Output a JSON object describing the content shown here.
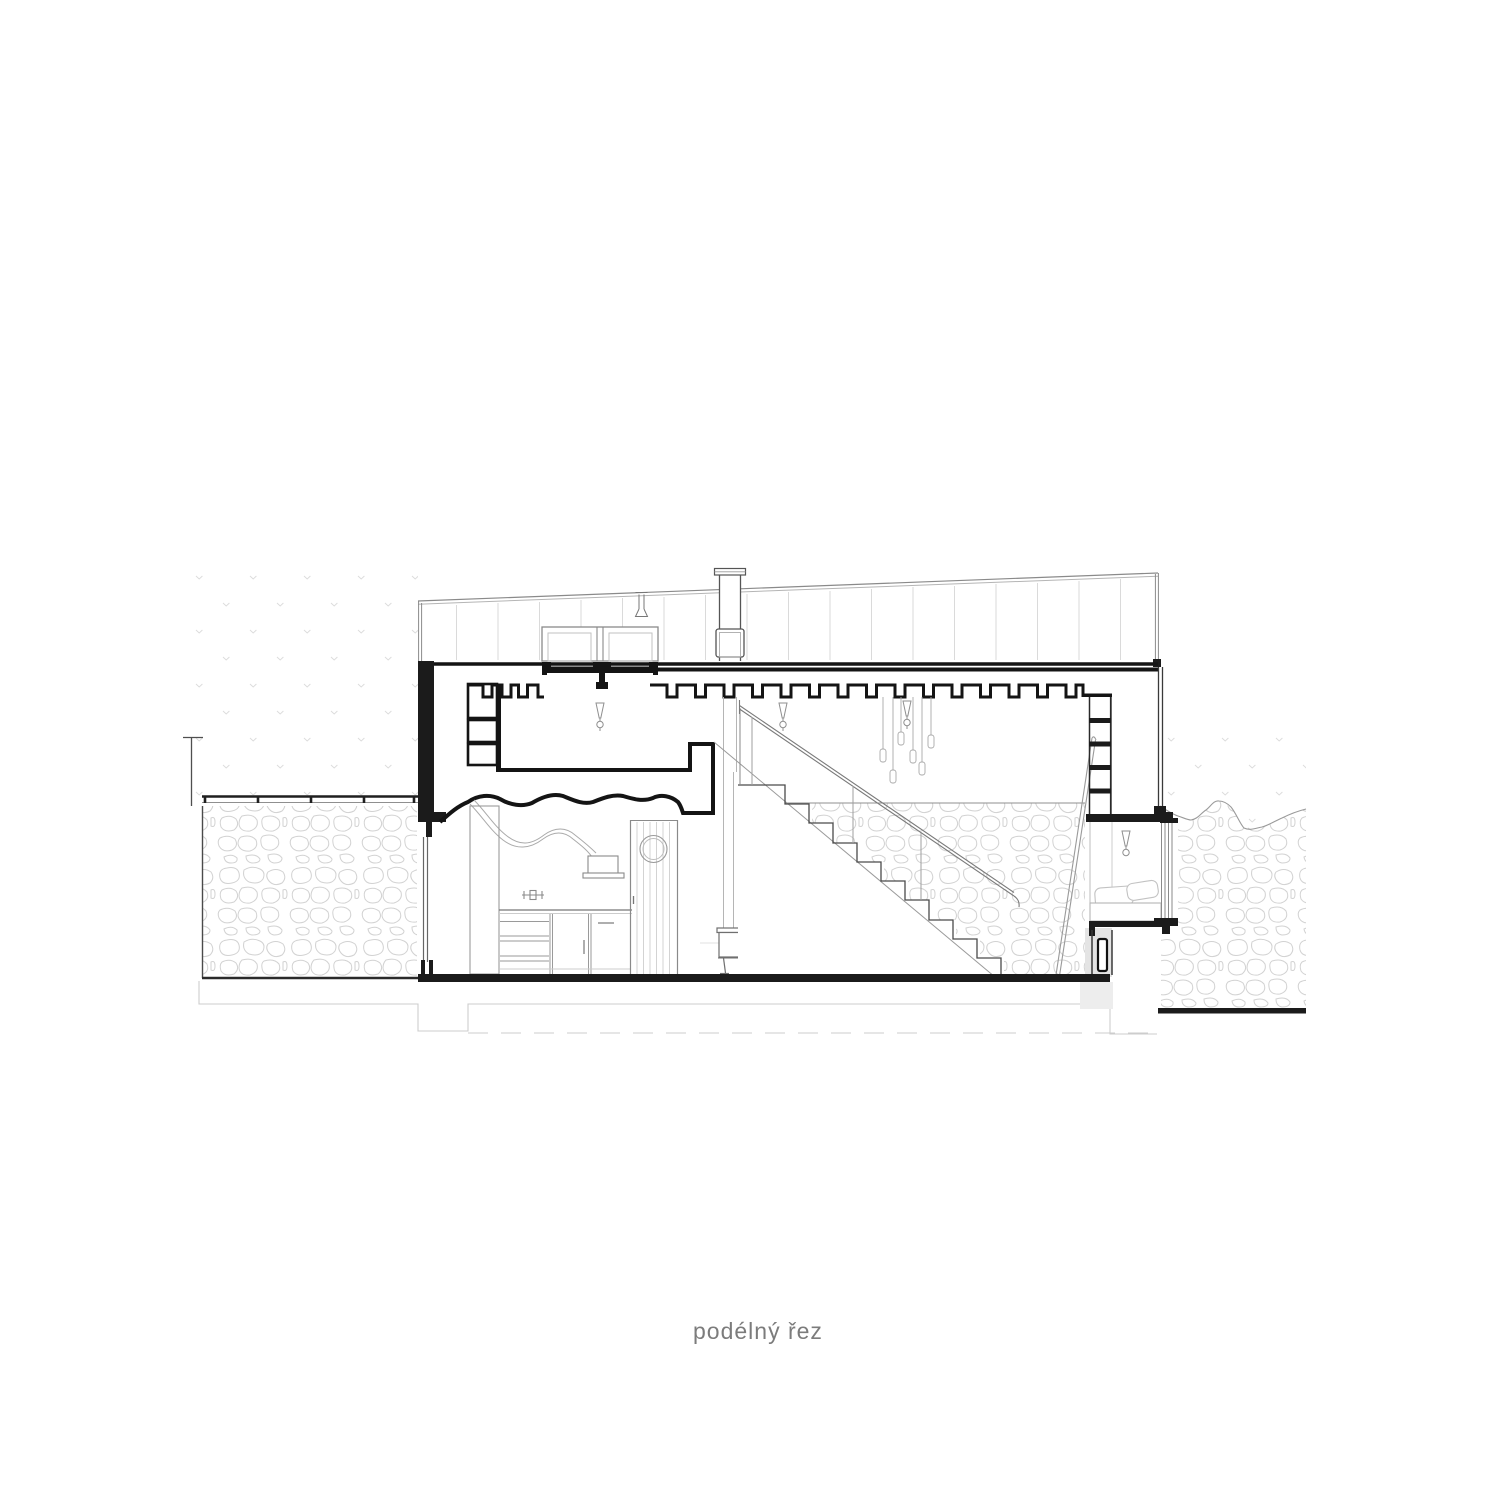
{
  "title": {
    "label": "podélný řez"
  },
  "palette": {
    "ink": "#1b1b1b",
    "line": "#555555",
    "mid": "#8f8f8f",
    "soft": "#b9b9b9",
    "faint": "#d6d6d6",
    "paper": "#ffffff",
    "text": "#7c7c7c"
  },
  "drawing": {
    "kind": "architectural-longitudinal-section",
    "depicted_elements": [
      "sloped-roof-band",
      "chimney",
      "roof-vent",
      "skylight-pair",
      "joist-ceiling-with-pockets",
      "pendant-light-cluster",
      "ceiling-light-symbols",
      "kitchen-cloud-ceiling",
      "extractor-duct-and-hood",
      "kitchen-cabinets-and-counter",
      "plank-door-with-porthole",
      "wood-stove-with-flue",
      "person-figure",
      "staircase-with-railing",
      "stone-feature-wall",
      "wall-ladder-rungs",
      "leaning-ladder",
      "bed-alcove-with-pillows",
      "side-window",
      "door-in-section",
      "left-terrace-deck",
      "stippled-ground",
      "rubble-stone-masonry",
      "foundation-dashed-line"
    ],
    "pendant_light_count": 6,
    "ceiling_light_symbol_count": 4
  }
}
